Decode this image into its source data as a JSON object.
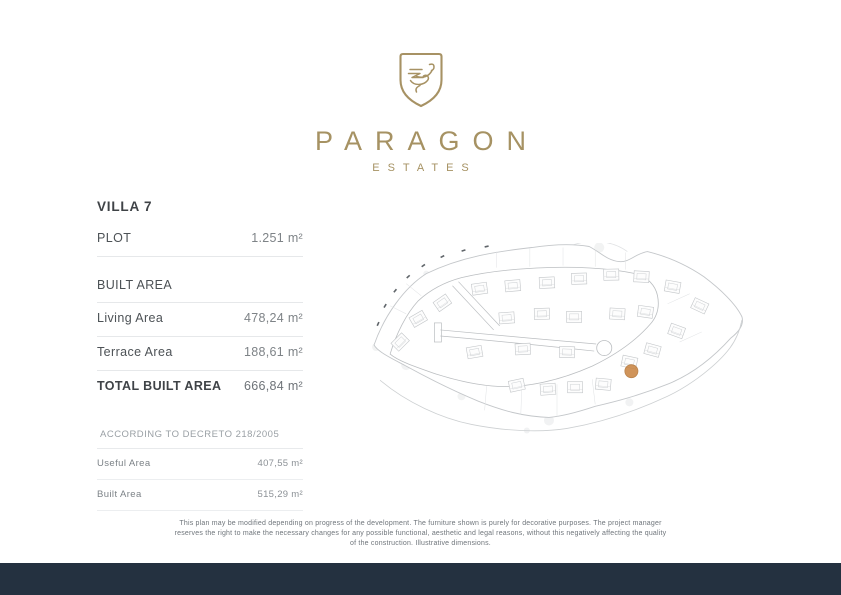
{
  "brand": {
    "name": "PARAGON",
    "subtitle": "ESTATES",
    "gold_color": "#a69263"
  },
  "villa": {
    "title": "VILLA 7",
    "plot": {
      "label": "PLOT",
      "value": "1.251 m²"
    },
    "built_area_heading": "BUILT AREA",
    "living": {
      "label": "Living Area",
      "value": "478,24 m²"
    },
    "terrace": {
      "label": "Terrace Area",
      "value": "188,61 m²"
    },
    "total": {
      "label": "TOTAL BUILT AREA",
      "value": "666,84 m²"
    },
    "decreto": {
      "heading": "ACCORDING TO DECRETO 218/2005",
      "useful": {
        "label": "Useful Area",
        "value": "407,55 m²"
      },
      "built": {
        "label": "Built Area",
        "value": "515,29 m²"
      }
    }
  },
  "site_plan": {
    "marker_villa": "7",
    "marker_color": "#c8823e",
    "line_color": "#c4c7ca"
  },
  "disclaimer": "This plan may be modified depending on progress of the development. The furniture shown is purely for decorative purposes. The project manager reserves the right to make the necessary changes for any possible functional, aesthetic and legal reasons, without this negatively affecting the quality of the construction. Illustrative dimensions.",
  "footer": {
    "bar_color": "#243140"
  }
}
